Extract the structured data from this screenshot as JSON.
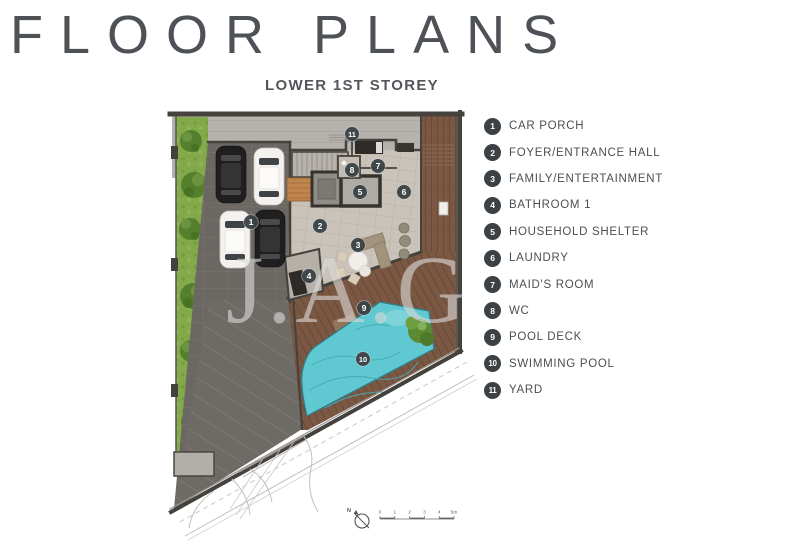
{
  "header": {
    "title": "FLOOR PLANS",
    "subtitle": "LOWER 1ST STOREY"
  },
  "legend": {
    "items": [
      {
        "number": "1",
        "label": "CAR PORCH"
      },
      {
        "number": "2",
        "label": "FOYER/ENTRANCE HALL"
      },
      {
        "number": "3",
        "label": "FAMILY/ENTERTAINMENT"
      },
      {
        "number": "4",
        "label": "BATHROOM 1"
      },
      {
        "number": "5",
        "label": "HOUSEHOLD SHELTER"
      },
      {
        "number": "6",
        "label": "LAUNDRY"
      },
      {
        "number": "7",
        "label": "MAID'S ROOM"
      },
      {
        "number": "8",
        "label": "WC"
      },
      {
        "number": "9",
        "label": "POOL DECK"
      },
      {
        "number": "10",
        "label": "SWIMMING POOL"
      },
      {
        "number": "11",
        "label": "YARD"
      }
    ]
  },
  "plan": {
    "watermark": "J.A.G",
    "north_label": "N",
    "scale_labels": [
      "0",
      "1",
      "2",
      "3",
      "4",
      "5m"
    ],
    "markers": [
      {
        "n": "1",
        "x": 251,
        "y": 222
      },
      {
        "n": "2",
        "x": 320,
        "y": 226
      },
      {
        "n": "3",
        "x": 358,
        "y": 245
      },
      {
        "n": "4",
        "x": 309,
        "y": 276
      },
      {
        "n": "5",
        "x": 360,
        "y": 192
      },
      {
        "n": "6",
        "x": 404,
        "y": 192
      },
      {
        "n": "7",
        "x": 378,
        "y": 166
      },
      {
        "n": "8",
        "x": 352,
        "y": 170
      },
      {
        "n": "9",
        "x": 364,
        "y": 308
      },
      {
        "n": "10",
        "x": 363,
        "y": 359
      },
      {
        "n": "11",
        "x": 352,
        "y": 134
      }
    ],
    "colors": {
      "marker_bg": "#3a4145",
      "pool": "#5fc8d0",
      "deck": "#7a5843",
      "lawn": "#83a94b",
      "car_porch": "#6b6762",
      "yard_concrete": "#b6b3ae",
      "interior_stone": "#c9c3ba",
      "wall": "#45413c",
      "title_text": "#4e5257"
    }
  }
}
